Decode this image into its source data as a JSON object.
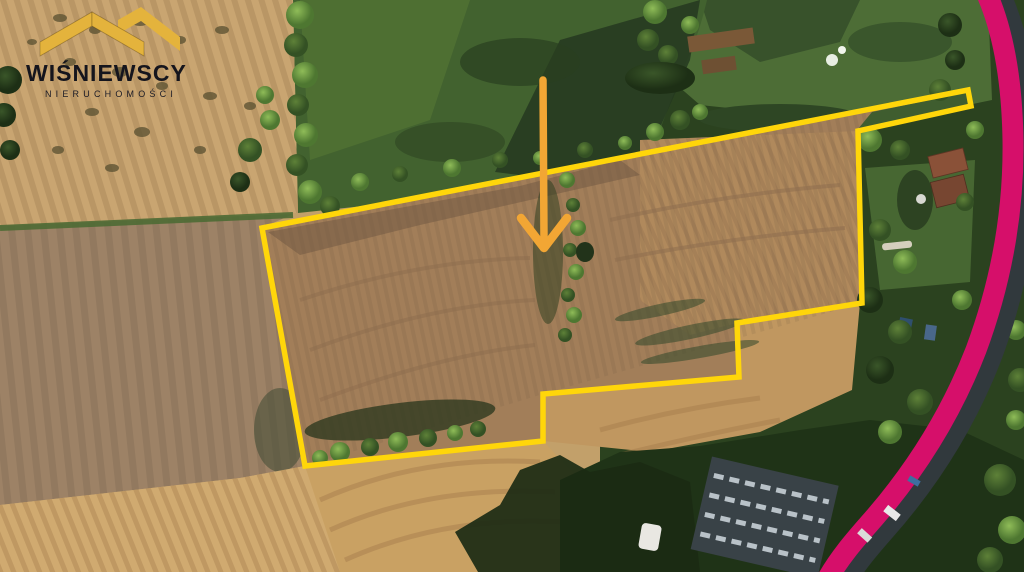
{
  "logo": {
    "title": "WIŚNIEWSCY",
    "subtitle": "NIERUCHOMOŚCI",
    "roof_color": "#E4B33C",
    "text_color": "#15151D"
  },
  "map_overlay": {
    "parcel_boundary": {
      "color": "#FFD60A",
      "stroke_width": 5.5,
      "points": "262,228 968,90 971,106 858,131 862,303 737,323 739,377 543,394 543,441 305,466"
    },
    "location_arrow": {
      "color": "#F2A634",
      "shaft_width": 7.5,
      "head_width": 8.5,
      "shaft_x1": 543,
      "shaft_y1": 80,
      "shaft_x2": 544,
      "shaft_y2": 238,
      "head_points": "521,218 544,248 567,218"
    },
    "road_highlight": {
      "color": "#D60F6A",
      "stroke_width": 21,
      "path": "M 986,-8 C 1003,30 1012,80 1013,140 C 1014,210 1002,280 976,350 C 952,412 917,470 868,525 C 855,540 840,557 828,578"
    }
  }
}
